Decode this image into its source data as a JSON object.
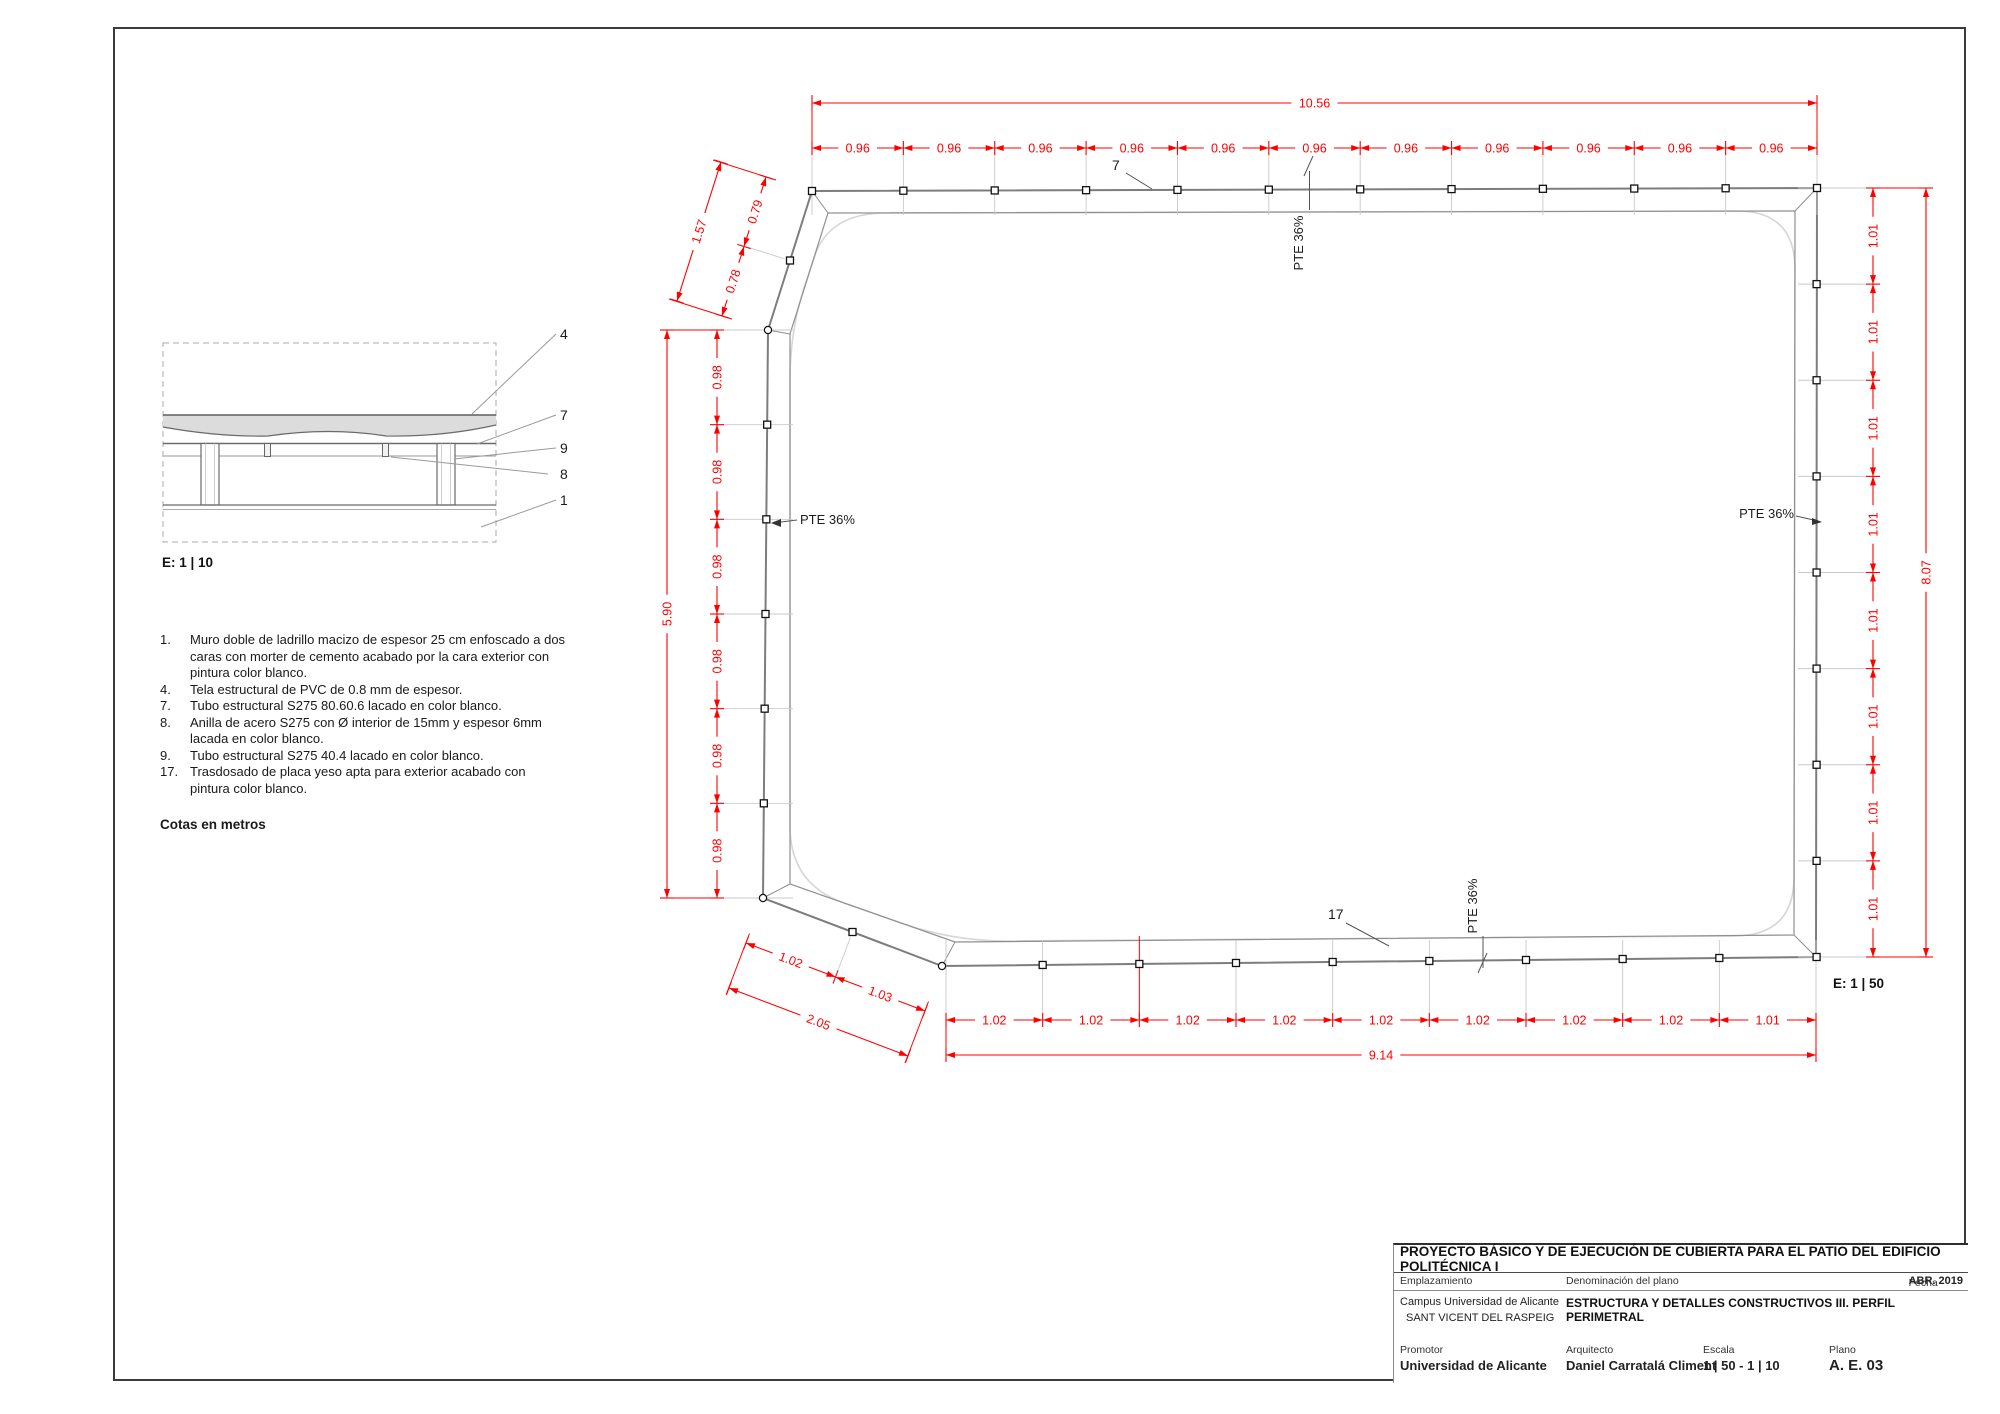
{
  "colors": {
    "red_dimension": "#ff0000",
    "profile_gray": "#7d7d7d",
    "membrane_gray": "#d6d6d6"
  },
  "plan": {
    "scale_label": "E: 1 | 50",
    "callout_top": "7",
    "callout_bottom": "17",
    "slope_label": "PTE 36%",
    "dims": {
      "top": {
        "total": "10.56",
        "segments": [
          "0.96",
          "0.96",
          "0.96",
          "0.96",
          "0.96",
          "0.96",
          "0.96",
          "0.96",
          "0.96",
          "0.96",
          "0.96"
        ]
      },
      "right": {
        "total": "8.07",
        "segments": [
          "1.01",
          "1.01",
          "1.01",
          "1.01",
          "1.01",
          "1.01",
          "1.01",
          "1.01"
        ]
      },
      "left": {
        "total": "5.90",
        "segments": [
          "0.98",
          "0.98",
          "0.98",
          "0.98",
          "0.98",
          "0.98"
        ]
      },
      "bottom": {
        "total": "9.14",
        "segments": [
          "1.02",
          "1.02",
          "1.02",
          "1.02",
          "1.02",
          "1.02",
          "1.02",
          "1.02",
          "1.01"
        ]
      },
      "chamfer_top_left": {
        "total": "1.57",
        "segments": [
          "0.78",
          "0.79"
        ]
      },
      "chamfer_bottom_left": {
        "total": "2.05",
        "segments": [
          "1.02",
          "1.03"
        ]
      }
    }
  },
  "detail": {
    "scale_label": "E: 1 | 10",
    "callouts": [
      "4",
      "7",
      "9",
      "8",
      "1"
    ]
  },
  "notes": {
    "items": [
      {
        "num": "1.",
        "text": "Muro doble de ladrillo macizo de espesor 25 cm enfoscado a dos caras con morter de cemento acabado por la cara exterior con pintura color blanco."
      },
      {
        "num": "4.",
        "text": "Tela estructural de PVC de 0.8 mm de espesor."
      },
      {
        "num": "7.",
        "text": "Tubo estructural S275 80.60.6 lacado en color blanco."
      },
      {
        "num": "8.",
        "text": "Anilla de acero S275 con Ø interior de 15mm y espesor 6mm lacada en color blanco."
      },
      {
        "num": "9.",
        "text": "Tubo estructural S275 40.4 lacado en color blanco."
      },
      {
        "num": "17.",
        "text": "Trasdosado de placa yeso apta para exterior acabado con pintura color blanco."
      }
    ],
    "footer": "Cotas en metros"
  },
  "title_block": {
    "project": "PROYECTO BÁSICO Y DE EJECUCIÓN DE CUBIERTA PARA EL PATIO DEL EDIFICIO POLITÉCNICA I",
    "emplazamiento_label": "Emplazamiento",
    "emplazamiento_line1": "Campus Universidad de Alicante",
    "emplazamiento_line2": "SANT VICENT DEL RASPEIG",
    "denominacion_label": "Denominación del plano",
    "denominacion": "ESTRUCTURA Y DETALLES CONSTRUCTIVOS III. PERFIL PERIMETRAL",
    "fecha_label": "Fecha",
    "fecha": "ABR. 2019",
    "promotor_label": "Promotor",
    "promotor": "Universidad de Alicante",
    "arquitecto_label": "Arquitecto",
    "arquitecto": "Daniel Carratalá Climent",
    "escala_label": "Escala",
    "escala": "1 | 50 - 1 | 10",
    "plano_label": "Plano",
    "plano": "A. E. 03"
  }
}
